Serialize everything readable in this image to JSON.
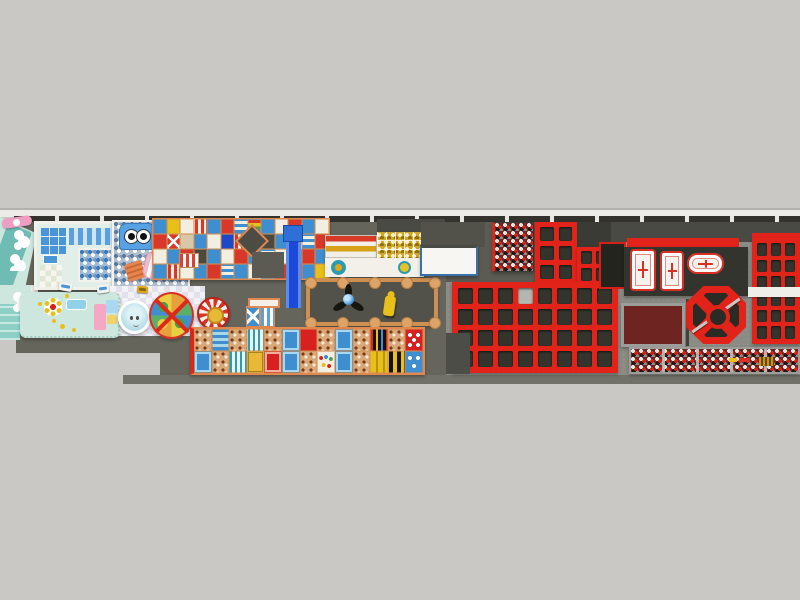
{
  "meta": {
    "scene": "indoor-playground-and-trampoline-park-floorplan-render",
    "view": "top-down-orthographic",
    "visible_text": "none"
  },
  "palette": {
    "bg": "#c9c8c5",
    "bgLine": "#b3b2ae",
    "wallLight": "#edebe7",
    "wallDark": "#33322d",
    "wallTick": "#e9e7e3",
    "floorA": "#65655c",
    "floorB": "#8b8b85",
    "floorShade": "#4a4a44",
    "floorStrip": "#71716a",
    "floorPatch": "#5b5b53",
    "red": "#e2231a",
    "bedDark": "#34342d",
    "bedLight": "#b6b6b0",
    "cream": "#f2eee2",
    "orange": "#e8854e",
    "frameOrange": "#cf8f52",
    "gameBase": "#e3c9a4",
    "blue": "#3f8fd0",
    "blueDeep": "#1d49d8",
    "sky": "#a8d8f2",
    "mint": "#cde7df",
    "mintDeep": "#6fbcb4",
    "teal": "#8fd0c6",
    "tealInk": "#2f9bb0",
    "pink": "#ef9ec2",
    "gold": "#e8c018",
    "foamBase": "#6e2420",
    "specWhite": "#e8e5e0",
    "specRed": "#cf2318",
    "specBlack": "#19191a"
  },
  "grids": {
    "upper_a": {
      "rows": 3,
      "cols": 2,
      "gap": 5,
      "pad": 5
    },
    "upper_b": {
      "rows": 2,
      "cols": 2,
      "gap": 4,
      "pad": 4
    },
    "main_court": {
      "rows": 4,
      "cols": 8,
      "gap": 5,
      "pad": 6,
      "light": [
        0,
        3
      ]
    },
    "right_grid": {
      "rows": 6,
      "cols": 3,
      "gap": 4,
      "pad": 5
    }
  },
  "mosaics": {
    "play_structure": {
      "prefix": "t",
      "names": {
        "r": "red-panel",
        "b": "blue-panel",
        "w": "cream-panel",
        "t": "tan-panel",
        "y": "yellow-panel",
        "k": "dark-platform",
        "B": "deep-blue-panel",
        "o": "orange-panel",
        "s": "red-white-stripe-panel",
        "c": "blue-white-stripe-panel",
        "R": "rainbow-panel",
        "x": "red-x-panel",
        "d": "ball-pit-cell"
      },
      "rows": [
        [
          "b",
          "y",
          "w",
          "s",
          "b",
          "r",
          "c",
          "R",
          "b",
          "w",
          "r",
          "b",
          "w"
        ],
        [
          "r",
          "x",
          "t",
          "b",
          "w",
          "B",
          "s",
          "b",
          "k",
          "b",
          "w",
          "c",
          "r"
        ],
        [
          "w",
          "b",
          "r",
          "k",
          "b",
          "w",
          "r",
          "b",
          "c",
          "w",
          "b",
          "r",
          "b"
        ],
        [
          "b",
          "s",
          "w",
          "b",
          "r",
          "c",
          "b",
          "w",
          "b",
          "r",
          "s",
          "b",
          "y"
        ]
      ]
    },
    "game_panels": {
      "prefix": "g",
      "names": {
        "g": "ball-pool-cell",
        "b": "blue-game-panel",
        "c": "blue-grid-panel",
        "v": "teal-stripe-panel",
        "r": "red-panel",
        "T": "red-table",
        "Y": "gold-panel",
        "y": "yellow-stripe-panel",
        "K": "black-color-bar-panel",
        "S": "black-yellow-stripe-panel",
        "D": "red-dice-panel",
        "E": "blue-dice-panel",
        "P": "rainbow-dot-panel",
        "w": "white-panel"
      },
      "rows": [
        [
          "g",
          "c",
          "g",
          "v",
          "g",
          "b",
          "r",
          "g",
          "b",
          "g",
          "K",
          "g",
          "D"
        ],
        [
          "b",
          "g",
          "v",
          "Y",
          "T",
          "b",
          "g",
          "P",
          "b",
          "g",
          "y",
          "S",
          "E"
        ]
      ]
    }
  }
}
